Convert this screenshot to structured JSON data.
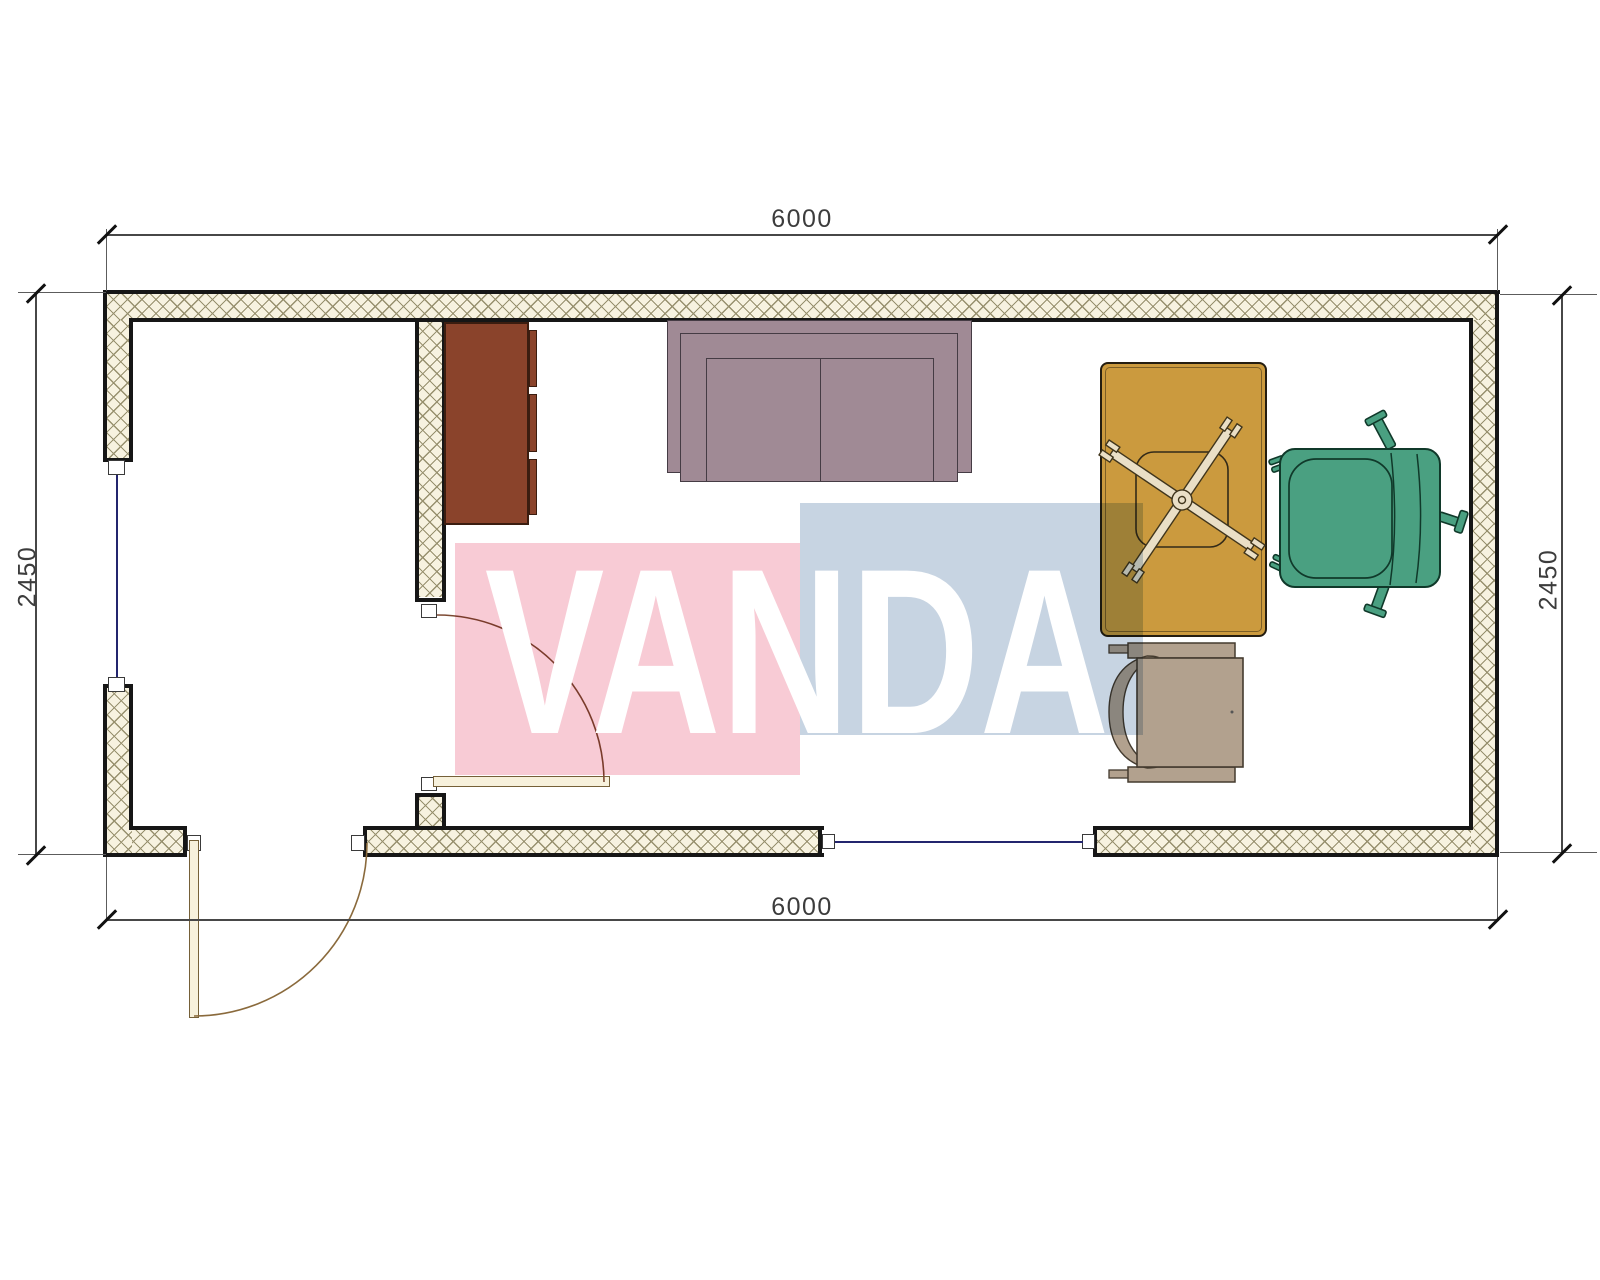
{
  "drawing": {
    "kind": "floor-plan-top-view",
    "wall_fill": "#f7f2e0",
    "wall_outline": "#161616",
    "hatch_line_color": "#97906e",
    "window_glazing_color": "#23256e",
    "door_swing_color": "#8a6a3c"
  },
  "dimensions": {
    "top_width_mm": "6000",
    "bottom_width_mm": "6000",
    "left_height_mm": "2450",
    "right_height_mm": "2450"
  },
  "watermark": {
    "text": "VANDA",
    "pink_block_color": "#f8cbd5",
    "blue_block_color": "#c7d4e2",
    "text_color": "#ffffff"
  },
  "furniture": [
    {
      "name": "cabinet",
      "color": "#8a432b"
    },
    {
      "name": "sofa",
      "color": "#a08a95"
    },
    {
      "name": "desk",
      "color": "#cb9a3e"
    },
    {
      "name": "desk-chair",
      "color": "#eadfc6"
    },
    {
      "name": "armchair",
      "color": "#4aa081"
    },
    {
      "name": "side-chair",
      "color": "#b2a18e"
    }
  ]
}
